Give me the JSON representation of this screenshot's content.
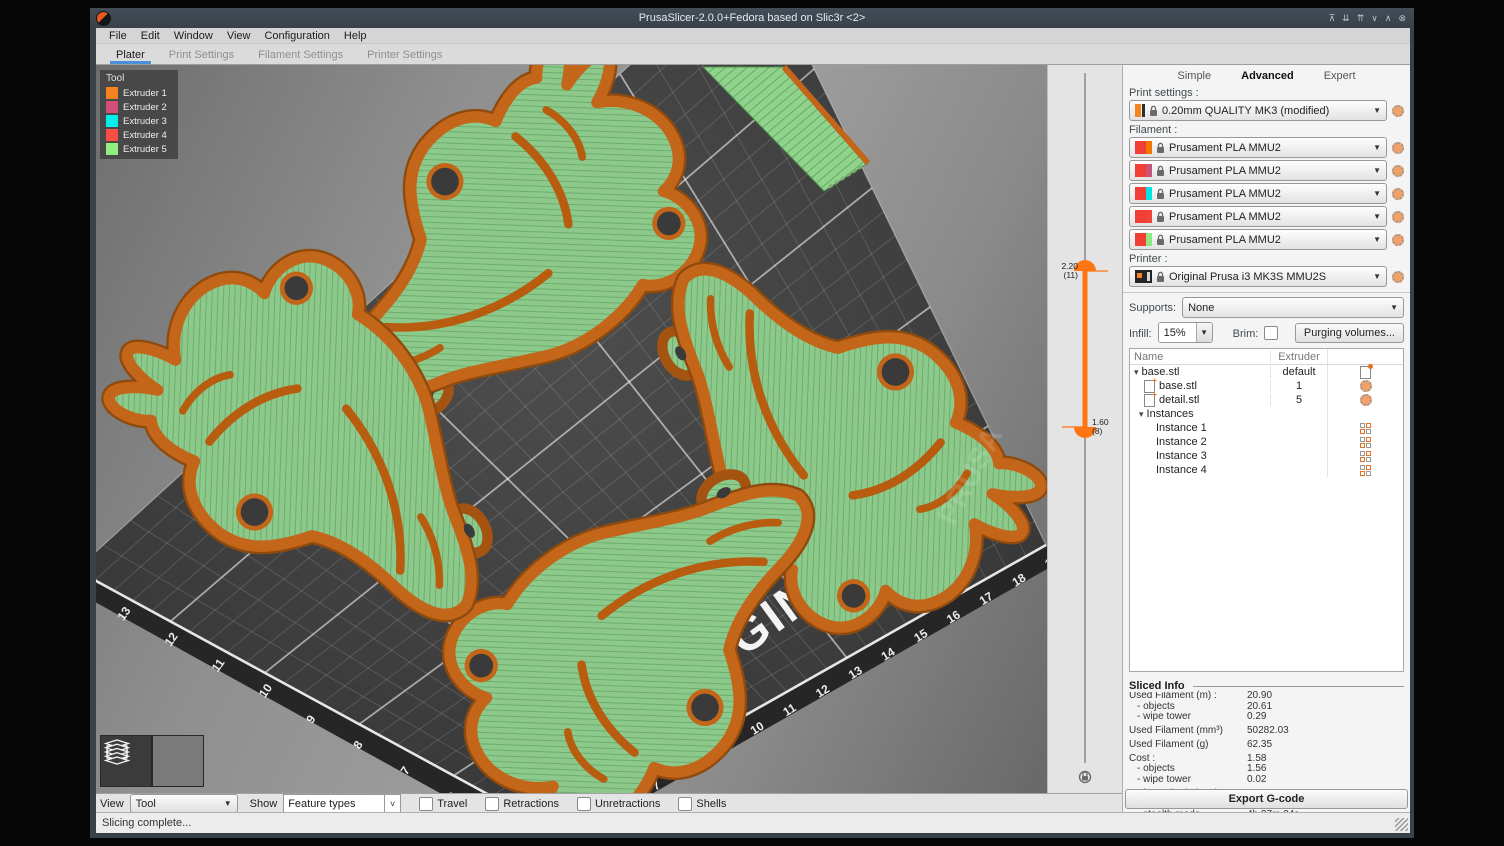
{
  "window": {
    "title": "PrusaSlicer-2.0.0+Fedora based on Slic3r <2>",
    "controls": [
      "⊼",
      "⇊",
      "⇈",
      "∨",
      "∧",
      "⊗"
    ],
    "menu": [
      "File",
      "Edit",
      "Window",
      "View",
      "Configuration",
      "Help"
    ],
    "tabs": [
      "Plater",
      "Print Settings",
      "Filament Settings",
      "Printer Settings"
    ],
    "active_tab": "Plater"
  },
  "legend": {
    "title": "Tool",
    "items": [
      {
        "label": "Extruder 1",
        "color": "#F5831F"
      },
      {
        "label": "Extruder 2",
        "color": "#D15078"
      },
      {
        "label": "Extruder 3",
        "color": "#00F0F0"
      },
      {
        "label": "Extruder 4",
        "color": "#F94F43"
      },
      {
        "label": "Extruder 5",
        "color": "#92EE7E"
      }
    ]
  },
  "layer_slider": {
    "upper_value": "2.20",
    "upper_layer": "(11)",
    "lower_value": "1.60",
    "lower_layer": "(8)"
  },
  "viewport": {
    "bed_numbers_left": [
      "13",
      "12",
      "11",
      "10",
      "9",
      "8",
      "7",
      "6"
    ],
    "bed_numbers_bottom": [
      "6",
      "7",
      "8",
      "9",
      "10",
      "11",
      "12",
      "13",
      "14",
      "15",
      "16",
      "17",
      "18",
      "19"
    ],
    "bed_text": "GINAL",
    "object_watermark": "PRUSA",
    "colors": {
      "perimeter_orange": "#C4661A",
      "infill_green": "#8CC98A",
      "bed_dark": "#3C3C3C"
    }
  },
  "settings_panel": {
    "modes": [
      "Simple",
      "Advanced",
      "Expert"
    ],
    "active_mode": "Advanced",
    "print_settings": {
      "label": "Print settings :",
      "value": "0.20mm QUALITY MK3 (modified)"
    },
    "filament": {
      "label": "Filament :",
      "primary_color": "#F23F36",
      "values": [
        {
          "value": "Prusament PLA MMU2",
          "color": "#F07800"
        },
        {
          "value": "Prusament PLA MMU2",
          "color": "#C85578"
        },
        {
          "value": "Prusament PLA MMU2",
          "color": "#00E5E5"
        },
        {
          "value": "Prusament PLA MMU2",
          "color": "#F04438"
        },
        {
          "value": "Prusament PLA MMU2",
          "color": "#8FE87F"
        }
      ]
    },
    "printer": {
      "label": "Printer :",
      "value": "Original Prusa i3 MK3S MMU2S"
    },
    "supports": {
      "label": "Supports:",
      "value": "None"
    },
    "infill": {
      "label": "Infill:",
      "value": "15%"
    },
    "brim": {
      "label": "Brim:",
      "checked": false
    },
    "purging_button": "Purging volumes...",
    "object_list": {
      "columns": [
        "Name",
        "Extruder"
      ],
      "rows": [
        {
          "name": "base.stl",
          "extruder": "default"
        },
        {
          "name": "base.stl",
          "extruder": "1"
        },
        {
          "name": "detail.stl",
          "extruder": "5"
        },
        {
          "name": "Instances",
          "extruder": ""
        },
        {
          "name": "Instance 1",
          "extruder": ""
        },
        {
          "name": "Instance 2",
          "extruder": ""
        },
        {
          "name": "Instance 3",
          "extruder": ""
        },
        {
          "name": "Instance 4",
          "extruder": ""
        }
      ]
    },
    "sliced_info": {
      "title": "Sliced Info",
      "rows": [
        {
          "label": "Used Filament (m) :",
          "value": "20.90"
        },
        {
          "label": "- objects",
          "value": "20.61"
        },
        {
          "label": "- wipe tower",
          "value": "0.29"
        },
        {
          "label": "Used Filament (mm³)",
          "value": "50282.03"
        },
        {
          "label": "Used Filament (g)",
          "value": "62.35"
        },
        {
          "label": "Cost :",
          "value": "1.58"
        },
        {
          "label": "- objects",
          "value": "1.56"
        },
        {
          "label": "- wipe tower",
          "value": "0.02"
        },
        {
          "label": "Estimated printing time :",
          "value": ""
        },
        {
          "label": "- normal mode",
          "value": "4h 25m 59s"
        },
        {
          "label": "- stealth mode",
          "value": "4h 27m 24s"
        },
        {
          "label": "Number of tool changes",
          "value": "1"
        }
      ]
    },
    "export_button": "Export G-code"
  },
  "bottom_toolbar": {
    "view_label": "View",
    "view_value": "Tool",
    "show_label": "Show",
    "show_value": "Feature types",
    "checkboxes": [
      {
        "label": "Travel",
        "checked": false
      },
      {
        "label": "Retractions",
        "checked": false
      },
      {
        "label": "Unretractions",
        "checked": false
      },
      {
        "label": "Shells",
        "checked": false
      }
    ]
  },
  "status_bar": {
    "text": "Slicing complete..."
  }
}
